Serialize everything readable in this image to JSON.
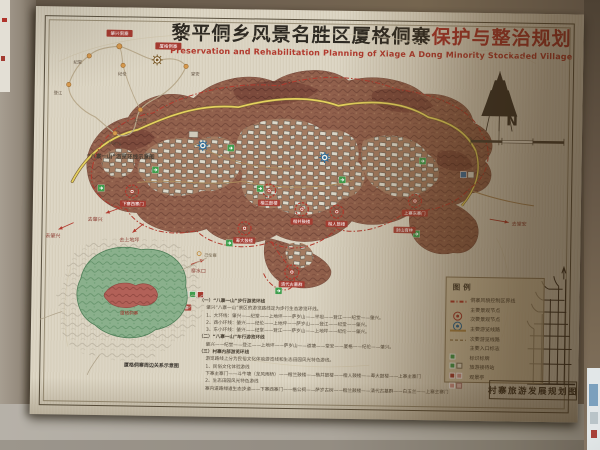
{
  "poster": {
    "title_cn_black": "黎平侗乡风景名胜区厦格侗寨",
    "title_cn_red": "保护与整治规划",
    "subtitle_en": "Preservation and Rehabilitation Planning of Xiage A Dong Minority Stockaded Village"
  },
  "route_inset": {
    "caption": "“八寨一山”游览环线示意图",
    "nodes": [
      "肇兴侗寨",
      "厦格侗寨",
      "纪堂",
      "纪伦",
      "登江",
      "堂安",
      "上地坪",
      "萨岁山"
    ]
  },
  "north_letter": "N",
  "map": {
    "node_labels": [
      "下寨西寨门",
      "楷兰鼓楼",
      "楷并鼓楼",
      "楷人鼓楼",
      "萆大鼓楼",
      "清代古墓群",
      "上寨东寨门",
      "封山育林"
    ],
    "direction_labels": [
      "去肇兴",
      "去肇兴",
      "去上地坪",
      "去堂安",
      "寨水口"
    ],
    "nearby_labels": [
      "己伦寨",
      "堂安侗寨"
    ]
  },
  "region_inset": {
    "center_label": "厦格侗寨",
    "caption": "厦格侗寨周边关系示意图"
  },
  "legend": {
    "title": "图例",
    "items": [
      "侗寨风貌控制区界线",
      "主要景观节点",
      "次要景观节点",
      "主要游览线路",
      "次要游览线路",
      "主要入口标志",
      "标识标牌",
      "旅游接待站",
      "观景亭"
    ]
  },
  "notes": {
    "lines": [
      "（一）“八寨一山”步行游览环线",
      "肇兴“八寨一山”景区的游览路线定为步行生态游览环线。",
      "1、大环线：肇兴——纪堂——上地坪——萨岁山——平坦——登江——纪堂——肇兴。",
      "2、西小环线：肇兴——纪伦——上地坪——萨岁山——登江——纪堂——肇兴。",
      "3、东小环线：肇兴——纪堂——登江——萨岁山——上地坪——纪伦——肇兴。",
      "（二）“八寨一山”车行游览环线",
      "肇兴——纪堂——登江——上地坪——萨岁山——道塘——堂安——厦格——纪伦——肇兴。",
      "（三）村寨内部游览环线",
      "游览路线上分为民俗文化体验游览线和生态田园风光特色游线。",
      "1、民俗文化体验游线",
      "下寨主寨门——斗牛塘（龙风雨桥）——楷兰鼓楼——楷并鼓楼——楷人鼓楼——萆大鼓楼——上寨主寨门",
      "2、生态田园风光特色游线",
      "寨内道路绿道生态步道——下寨西寨门——楷公祠——萨岁古树——楷兰鼓楼——清代古墓群——白玉兰——上寨主寨门"
    ]
  },
  "bottom_caption": "村寨旅游发展规划图",
  "colors": {
    "accent_red": "#a63a30",
    "node_blue": "#2a6a9a",
    "entry_green": "#3f9e4d",
    "road_yellow": "#e5d15e",
    "forest_green": "#87b08a"
  }
}
